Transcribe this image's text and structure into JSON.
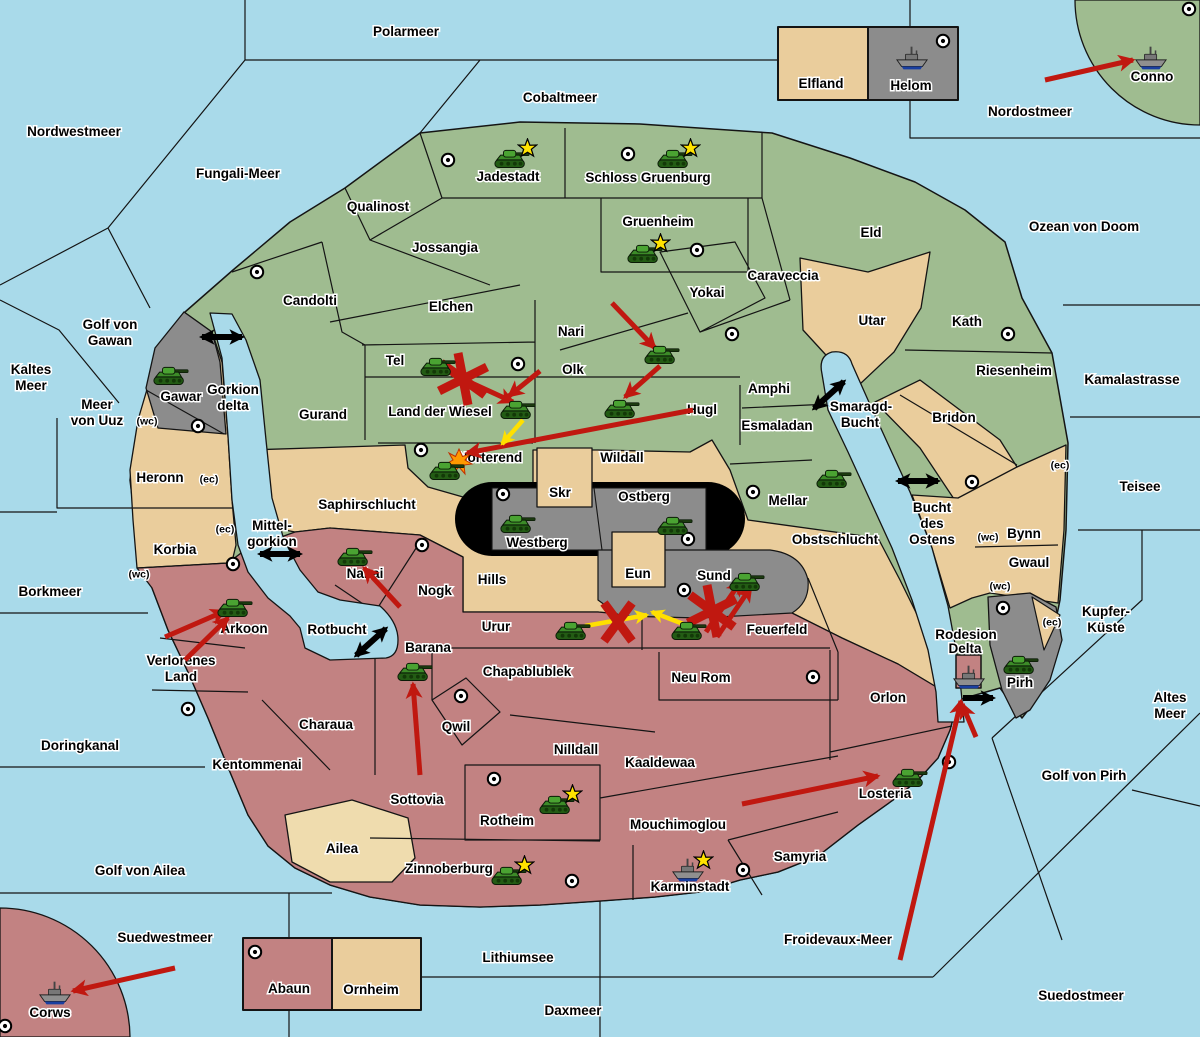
{
  "map": {
    "palette": {
      "sea": "#A9DAEA",
      "green": "#9FBC90",
      "tan": "#EACD9C",
      "tan_light": "#EFDCAE",
      "rose": "#C28282",
      "gray": "#8C8C8C",
      "black": "#000000",
      "border": "#141414",
      "arrow_red": "#C01810",
      "arrow_yellow": "#FFE000",
      "star": "#FFE300",
      "explosion": "#FF9900",
      "dot_fill": "#FFFFFF"
    },
    "sea_labels": [
      {
        "t": "Polarmeer",
        "x": 406,
        "y": 32
      },
      {
        "t": "Cobaltmeer",
        "x": 560,
        "y": 98
      },
      {
        "t": "Nordwestmeer",
        "x": 74,
        "y": 132
      },
      {
        "t": "Nordostmeer",
        "x": 1030,
        "y": 112
      },
      {
        "t": "Fungali-Meer",
        "x": 238,
        "y": 174
      },
      {
        "t": "Ozean von Doom",
        "x": 1084,
        "y": 227
      },
      {
        "t": "Golf von",
        "x": 110,
        "y": 325
      },
      {
        "t": "Gawan",
        "x": 110,
        "y": 341
      },
      {
        "t": "Kaltes",
        "x": 31,
        "y": 370
      },
      {
        "t": "Meer",
        "x": 31,
        "y": 386
      },
      {
        "t": "Meer",
        "x": 97,
        "y": 405
      },
      {
        "t": "von Uuz",
        "x": 97,
        "y": 421
      },
      {
        "t": "Kamalastrasse",
        "x": 1132,
        "y": 380
      },
      {
        "t": "Teisee",
        "x": 1140,
        "y": 487
      },
      {
        "t": "Borkmeer",
        "x": 50,
        "y": 592
      },
      {
        "t": "Kupfer-",
        "x": 1106,
        "y": 612
      },
      {
        "t": "Küste",
        "x": 1106,
        "y": 628
      },
      {
        "t": "Altes",
        "x": 1170,
        "y": 698
      },
      {
        "t": "Meer",
        "x": 1170,
        "y": 714
      },
      {
        "t": "Golf von Pirh",
        "x": 1084,
        "y": 776
      },
      {
        "t": "Doringkanal",
        "x": 80,
        "y": 746
      },
      {
        "t": "Golf von Ailea",
        "x": 140,
        "y": 871
      },
      {
        "t": "Froidevaux-Meer",
        "x": 838,
        "y": 940
      },
      {
        "t": "Suedwestmeer",
        "x": 165,
        "y": 938
      },
      {
        "t": "Lithiumsee",
        "x": 518,
        "y": 958
      },
      {
        "t": "Daxmeer",
        "x": 573,
        "y": 1011
      },
      {
        "t": "Suedostmeer",
        "x": 1081,
        "y": 996
      },
      {
        "t": "Gorkion",
        "x": 233,
        "y": 390
      },
      {
        "t": "delta",
        "x": 233,
        "y": 406
      },
      {
        "t": "Mittel-",
        "x": 272,
        "y": 526
      },
      {
        "t": "gorkion",
        "x": 272,
        "y": 542
      },
      {
        "t": "Smaragd-",
        "x": 861,
        "y": 407
      },
      {
        "t": "Bucht",
        "x": 860,
        "y": 423
      },
      {
        "t": "Bucht",
        "x": 932,
        "y": 508
      },
      {
        "t": "des",
        "x": 932,
        "y": 524
      },
      {
        "t": "Ostens",
        "x": 932,
        "y": 540
      },
      {
        "t": "Rotbucht",
        "x": 337,
        "y": 630
      },
      {
        "t": "Rodesion",
        "x": 966,
        "y": 635
      },
      {
        "t": "Delta",
        "x": 965,
        "y": 649
      }
    ],
    "land_labels": [
      {
        "t": "Jadestadt",
        "x": 508,
        "y": 177
      },
      {
        "t": "Schloss Gruenburg",
        "x": 648,
        "y": 178
      },
      {
        "t": "Qualinost",
        "x": 378,
        "y": 207
      },
      {
        "t": "Jossangia",
        "x": 445,
        "y": 248
      },
      {
        "t": "Gruenheim",
        "x": 658,
        "y": 222
      },
      {
        "t": "Caraveccia",
        "x": 783,
        "y": 276
      },
      {
        "t": "Yokai",
        "x": 707,
        "y": 293
      },
      {
        "t": "Eld",
        "x": 871,
        "y": 233
      },
      {
        "t": "Candolti",
        "x": 310,
        "y": 301
      },
      {
        "t": "Elchen",
        "x": 451,
        "y": 307
      },
      {
        "t": "Nari",
        "x": 571,
        "y": 332
      },
      {
        "t": "Olk",
        "x": 573,
        "y": 370
      },
      {
        "t": "Tel",
        "x": 395,
        "y": 361
      },
      {
        "t": "Land der Wiesel",
        "x": 440,
        "y": 412
      },
      {
        "t": "Hugl",
        "x": 702,
        "y": 410
      },
      {
        "t": "Amphi",
        "x": 769,
        "y": 389
      },
      {
        "t": "Esmaladan",
        "x": 777,
        "y": 426
      },
      {
        "t": "Gurand",
        "x": 323,
        "y": 415
      },
      {
        "t": "Norterend",
        "x": 490,
        "y": 458
      },
      {
        "t": "Mellar",
        "x": 788,
        "y": 501
      },
      {
        "t": "Utar",
        "x": 872,
        "y": 321
      },
      {
        "t": "Kath",
        "x": 967,
        "y": 322
      },
      {
        "t": "Riesenheim",
        "x": 1014,
        "y": 371
      },
      {
        "t": "Bridon",
        "x": 954,
        "y": 418
      },
      {
        "t": "Wildall",
        "x": 622,
        "y": 458
      },
      {
        "t": "Saphirschlucht",
        "x": 367,
        "y": 505
      },
      {
        "t": "Heronn",
        "x": 160,
        "y": 478
      },
      {
        "t": "Korbia",
        "x": 175,
        "y": 550
      },
      {
        "t": "Gawar",
        "x": 181,
        "y": 397
      },
      {
        "t": "Obstschlucht",
        "x": 835,
        "y": 540
      },
      {
        "t": "Bynn",
        "x": 1024,
        "y": 534
      },
      {
        "t": "Gwaul",
        "x": 1029,
        "y": 563
      },
      {
        "t": "Skr",
        "x": 560,
        "y": 493
      },
      {
        "t": "Eun",
        "x": 638,
        "y": 574
      },
      {
        "t": "Elfland",
        "x": 821,
        "y": 84
      },
      {
        "t": "Helom",
        "x": 911,
        "y": 86
      },
      {
        "t": "Ornheim",
        "x": 371,
        "y": 990
      },
      {
        "t": "Abaun",
        "x": 289,
        "y": 989
      },
      {
        "t": "Ailea",
        "x": 342,
        "y": 849
      },
      {
        "t": "Westberg",
        "x": 537,
        "y": 543
      },
      {
        "t": "Ostberg",
        "x": 644,
        "y": 497
      },
      {
        "t": "Sund",
        "x": 714,
        "y": 576
      },
      {
        "t": "Pirh",
        "x": 1020,
        "y": 683
      },
      {
        "t": "Conno",
        "x": 1152,
        "y": 77
      },
      {
        "t": "Corws",
        "x": 50,
        "y": 1013
      },
      {
        "t": "Nabai",
        "x": 365,
        "y": 574
      },
      {
        "t": "Nogk",
        "x": 435,
        "y": 591
      },
      {
        "t": "Hills",
        "x": 492,
        "y": 580
      },
      {
        "t": "Urur",
        "x": 496,
        "y": 627
      },
      {
        "t": "Feuerfeld",
        "x": 777,
        "y": 630
      },
      {
        "t": "Arkoon",
        "x": 244,
        "y": 629
      },
      {
        "t": "Verlorenes",
        "x": 181,
        "y": 661
      },
      {
        "t": "Land",
        "x": 181,
        "y": 677
      },
      {
        "t": "Barana",
        "x": 428,
        "y": 648
      },
      {
        "t": "Chapablublek",
        "x": 527,
        "y": 672
      },
      {
        "t": "Neu Rom",
        "x": 701,
        "y": 678
      },
      {
        "t": "Charaua",
        "x": 326,
        "y": 725
      },
      {
        "t": "Qwil",
        "x": 456,
        "y": 727
      },
      {
        "t": "Nilldall",
        "x": 576,
        "y": 750
      },
      {
        "t": "Kaaldewaa",
        "x": 660,
        "y": 763
      },
      {
        "t": "Kentommenai",
        "x": 257,
        "y": 765
      },
      {
        "t": "Sottovia",
        "x": 417,
        "y": 800
      },
      {
        "t": "Rotheim",
        "x": 507,
        "y": 821
      },
      {
        "t": "Mouchimoglou",
        "x": 678,
        "y": 825
      },
      {
        "t": "Losteria",
        "x": 885,
        "y": 794
      },
      {
        "t": "Orlon",
        "x": 888,
        "y": 698
      },
      {
        "t": "Zinnoberburg",
        "x": 449,
        "y": 869
      },
      {
        "t": "Karminstadt",
        "x": 690,
        "y": 887
      },
      {
        "t": "Samyria",
        "x": 800,
        "y": 857
      }
    ],
    "coast_tags": [
      {
        "t": "(wc)",
        "x": 147,
        "y": 421
      },
      {
        "t": "(ec)",
        "x": 209,
        "y": 479
      },
      {
        "t": "(ec)",
        "x": 225,
        "y": 529
      },
      {
        "t": "(wc)",
        "x": 139,
        "y": 574
      },
      {
        "t": "(wc)",
        "x": 988,
        "y": 537
      },
      {
        "t": "(ec)",
        "x": 1060,
        "y": 465
      },
      {
        "t": "(wc)",
        "x": 1000,
        "y": 586
      },
      {
        "t": "(ec)",
        "x": 1052,
        "y": 622
      }
    ],
    "supply_centers": [
      [
        448,
        160
      ],
      [
        628,
        154
      ],
      [
        697,
        250
      ],
      [
        732,
        334
      ],
      [
        518,
        364
      ],
      [
        421,
        450
      ],
      [
        198,
        426
      ],
      [
        257,
        272
      ],
      [
        503,
        494
      ],
      [
        688,
        539
      ],
      [
        684,
        590
      ],
      [
        753,
        492
      ],
      [
        1008,
        334
      ],
      [
        972,
        482
      ],
      [
        1003,
        608
      ],
      [
        943,
        41
      ],
      [
        1189,
        9
      ],
      [
        422,
        545
      ],
      [
        233,
        564
      ],
      [
        188,
        709
      ],
      [
        461,
        696
      ],
      [
        813,
        677
      ],
      [
        949,
        762
      ],
      [
        494,
        779
      ],
      [
        572,
        881
      ],
      [
        743,
        870
      ],
      [
        255,
        952
      ],
      [
        5,
        1026
      ]
    ],
    "units": [
      {
        "t": "army",
        "r": "jadestadt",
        "x": 512,
        "y": 158,
        "star": true
      },
      {
        "t": "army",
        "r": "schloss-gruenburg",
        "x": 675,
        "y": 158,
        "star": true
      },
      {
        "t": "army",
        "r": "gruenheim",
        "x": 645,
        "y": 253,
        "star": true
      },
      {
        "t": "army",
        "r": "tel",
        "x": 438,
        "y": 366,
        "star": false
      },
      {
        "t": "army",
        "r": "olk",
        "x": 662,
        "y": 354,
        "star": false
      },
      {
        "t": "army",
        "r": "hugl",
        "x": 622,
        "y": 408,
        "star": false
      },
      {
        "t": "army",
        "r": "land-der-wiesel",
        "x": 518,
        "y": 409,
        "star": false
      },
      {
        "t": "army",
        "r": "norterend",
        "x": 447,
        "y": 470,
        "star": false
      },
      {
        "t": "army",
        "r": "gawar",
        "x": 171,
        "y": 375,
        "star": false
      },
      {
        "t": "army",
        "r": "westberg",
        "x": 518,
        "y": 523,
        "star": false
      },
      {
        "t": "army",
        "r": "ostberg",
        "x": 675,
        "y": 525,
        "star": false
      },
      {
        "t": "army",
        "r": "mellar",
        "x": 834,
        "y": 478,
        "star": false
      },
      {
        "t": "army",
        "r": "sund",
        "x": 747,
        "y": 581,
        "star": false
      },
      {
        "t": "army",
        "r": "nabai",
        "x": 355,
        "y": 556,
        "star": false
      },
      {
        "t": "army",
        "r": "arkoon",
        "x": 235,
        "y": 607,
        "star": false
      },
      {
        "t": "army",
        "r": "barana",
        "x": 415,
        "y": 671,
        "star": false
      },
      {
        "t": "army",
        "r": "urur",
        "x": 573,
        "y": 630,
        "star": false
      },
      {
        "t": "army",
        "r": "feuerfeld",
        "x": 689,
        "y": 630,
        "star": false
      },
      {
        "t": "army",
        "r": "rotheim",
        "x": 557,
        "y": 804,
        "star": true
      },
      {
        "t": "army",
        "r": "zinnoberburg",
        "x": 509,
        "y": 875,
        "star": true
      },
      {
        "t": "army",
        "r": "losteria",
        "x": 910,
        "y": 777,
        "star": false
      },
      {
        "t": "army",
        "r": "pirh",
        "x": 1021,
        "y": 664,
        "star": false
      },
      {
        "t": "fleet",
        "r": "helom",
        "x": 912,
        "y": 58,
        "star": false
      },
      {
        "t": "fleet",
        "r": "conno",
        "x": 1151,
        "y": 58,
        "star": false
      },
      {
        "t": "fleet",
        "r": "rodesion-delta",
        "x": 969,
        "y": 677,
        "star": false
      },
      {
        "t": "fleet",
        "r": "karminstadt",
        "x": 688,
        "y": 870,
        "star": true
      },
      {
        "t": "fleet",
        "r": "corws",
        "x": 55,
        "y": 993,
        "star": false
      }
    ],
    "red_arrows": [
      [
        1045,
        80,
        1133,
        60
      ],
      [
        612,
        303,
        655,
        348
      ],
      [
        660,
        366,
        625,
        397
      ],
      [
        693,
        410,
        467,
        453
      ],
      [
        452,
        374,
        513,
        402
      ],
      [
        540,
        371,
        509,
        396
      ],
      [
        400,
        607,
        364,
        568
      ],
      [
        165,
        637,
        225,
        611
      ],
      [
        185,
        660,
        228,
        618
      ],
      [
        420,
        775,
        413,
        684
      ],
      [
        742,
        804,
        878,
        776
      ],
      [
        900,
        960,
        961,
        701
      ],
      [
        976,
        737,
        962,
        704
      ],
      [
        706,
        632,
        741,
        581
      ],
      [
        717,
        637,
        751,
        587
      ],
      [
        175,
        968,
        73,
        991
      ]
    ],
    "yellow_arrows": [
      [
        585,
        626,
        647,
        615
      ],
      [
        686,
        625,
        652,
        612
      ],
      [
        523,
        420,
        502,
        444
      ]
    ],
    "straits": [
      {
        "x": 222,
        "y": 337,
        "rot": 0,
        "heads": 2
      },
      {
        "x": 280,
        "y": 554,
        "rot": 0,
        "heads": 2
      },
      {
        "x": 829,
        "y": 395,
        "rot": -42,
        "heads": 2
      },
      {
        "x": 371,
        "y": 642,
        "rot": -42,
        "heads": 2
      },
      {
        "x": 918,
        "y": 481,
        "rot": 0,
        "heads": 2
      },
      {
        "x": 978,
        "y": 698,
        "rot": 0,
        "heads": 1
      }
    ],
    "marks": [
      {
        "k": "x",
        "x": 618,
        "y": 622
      },
      {
        "k": "ast",
        "x": 463,
        "y": 379
      },
      {
        "k": "ast",
        "x": 712,
        "y": 611
      },
      {
        "k": "exp",
        "x": 459,
        "y": 461
      }
    ]
  }
}
